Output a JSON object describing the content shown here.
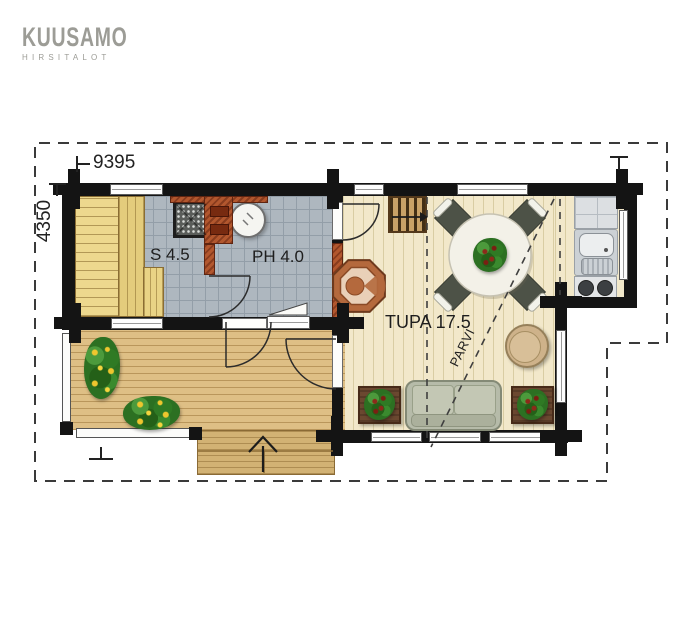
{
  "logo": {
    "title": "KUUSAMO",
    "subtitle": "HIRSITALOT"
  },
  "dimensions": {
    "width_label": "9395",
    "height_label": "4350"
  },
  "rooms": {
    "sauna": "S 4.5",
    "washroom": "PH 4.0",
    "living": "TUPA 17.5",
    "loft": "PARVI"
  },
  "colors": {
    "wall": "#141414",
    "tile_floor": "#aeb7bf",
    "wood_floor": "#f2e8ca",
    "terrace_deck": "#debf85",
    "masonry": "#b2572e",
    "sofa": "#b6bba9",
    "plant_green": "#2f7a27",
    "flower_yellow": "#eec62e",
    "logo_gray": "#9c9c96"
  }
}
